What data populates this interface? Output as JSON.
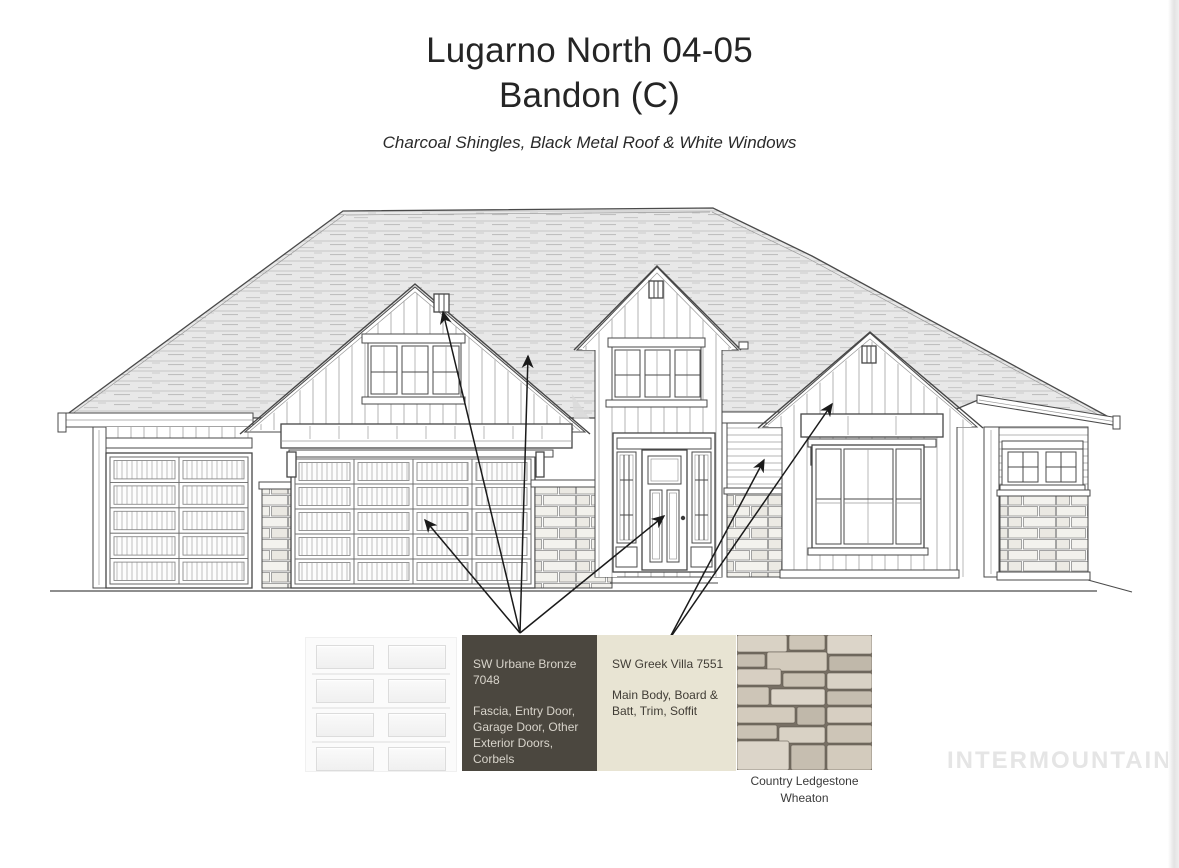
{
  "header": {
    "title_line1": "Lugarno North 04-05",
    "title_line2": "Bandon (C)",
    "subtitle": "Charcoal Shingles, Black Metal Roof & White Windows"
  },
  "drawing": {
    "type": "front elevation line drawing",
    "features": [
      "hip roof with shingle texture",
      "three front-facing gables with board and batten siding",
      "single garage door",
      "double garage door",
      "entry door with sidelights",
      "triple windows in gables",
      "picture window with wood canopy",
      "paired square windows",
      "stone wainscot pillars"
    ]
  },
  "swatches": {
    "garage_door": {
      "kind": "image",
      "label": "white paneled garage door sample"
    },
    "urbane_bronze": {
      "name": "SW Urbane Bronze\n7048",
      "uses": "Fascia, Entry Door,\nGarage Door, Other\nExterior Doors, Corbels",
      "color": "#4b473f",
      "text_color": "#d8d4cb"
    },
    "greek_villa": {
      "name": "SW Greek Villa 7551",
      "uses": "Main Body, Board &\nBatt, Trim, Soffit",
      "color": "#e8e4d3",
      "text_color": "#403c35"
    },
    "stone": {
      "caption": "Country Ledgestone\nWheaton"
    }
  },
  "watermark": {
    "text": "INTERMOUNTAIN",
    "color": "#e5e5e5"
  },
  "annotations": {
    "arrow_color": "#1a1a1a",
    "arrows": [
      {
        "from": [
          520,
          633
        ],
        "to": [
          443,
          312
        ],
        "target": "gable-peak-corbel"
      },
      {
        "from": [
          520,
          633
        ],
        "to": [
          528,
          356
        ],
        "target": "roof-fascia"
      },
      {
        "from": [
          520,
          633
        ],
        "to": [
          425,
          520
        ],
        "target": "double-garage-door"
      },
      {
        "from": [
          520,
          633
        ],
        "to": [
          664,
          516
        ],
        "target": "entry-door"
      },
      {
        "from": [
          668,
          641
        ],
        "to": [
          764,
          460
        ],
        "target": "porch-return-siding"
      },
      {
        "from": [
          668,
          641
        ],
        "to": [
          832,
          404
        ],
        "target": "right-gable-board-and-batten"
      }
    ]
  }
}
